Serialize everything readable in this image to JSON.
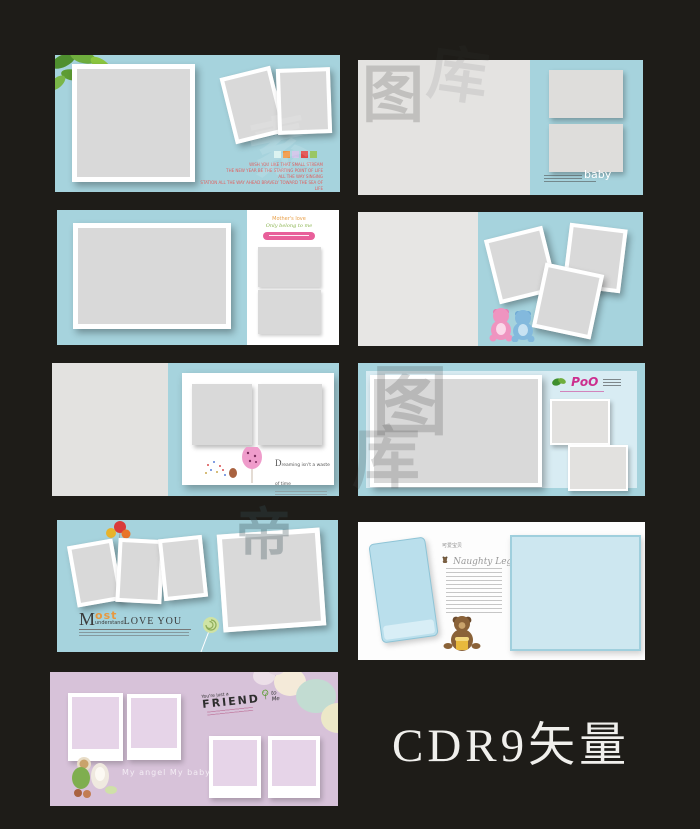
{
  "colors": {
    "background": "#1e1c18",
    "panel_blue": "#a6d3dd",
    "panel_pink": "#d7c2d9",
    "photo_gray": "#d9d9d9",
    "poem_red": "#e06060",
    "logo_magenta": "#cc2e8e",
    "most_orange": "#e8983f"
  },
  "caption": "CDR9矢量",
  "watermark_chars": {
    "c1": "图",
    "c2": "库",
    "c3": "图",
    "c4": "库",
    "c5": "帝",
    "c6": "素"
  },
  "panel1": {
    "poem": [
      "WISH YOU LIKE THAT SMALL STREAM",
      "THE NEW YEAR BE THE STARTING POINT OF LIFE",
      "ALL THE WAY SINGING",
      "STATION ALL THE WAY AHEAD BRAVELY TOWARD THE SEA OF LIFE"
    ],
    "swatches": [
      "#d8f2ef",
      "#ef9440",
      "#cdc2e8",
      "#e04848",
      "#99c664"
    ]
  },
  "panel2": {
    "baby_label": "baby"
  },
  "panel3": {
    "line1": "Mother's love",
    "line2": "Only belong to me"
  },
  "panel5": {
    "initial": "D",
    "slogan_rest": "reaming isn't a waste of time"
  },
  "panel6": {
    "logo": "PoO"
  },
  "panel7": {
    "m": "M",
    "ost": "ost",
    "understand": "understand",
    "love": "LOVE YOU"
  },
  "panel8": {
    "cn_title": "可爱宝贝",
    "script_title": "Naughty Legs"
  },
  "panel9": {
    "pre": "You're just a",
    "friend": "FRIEND",
    "post": "to Me",
    "angel_text": "My angel  My baby"
  }
}
